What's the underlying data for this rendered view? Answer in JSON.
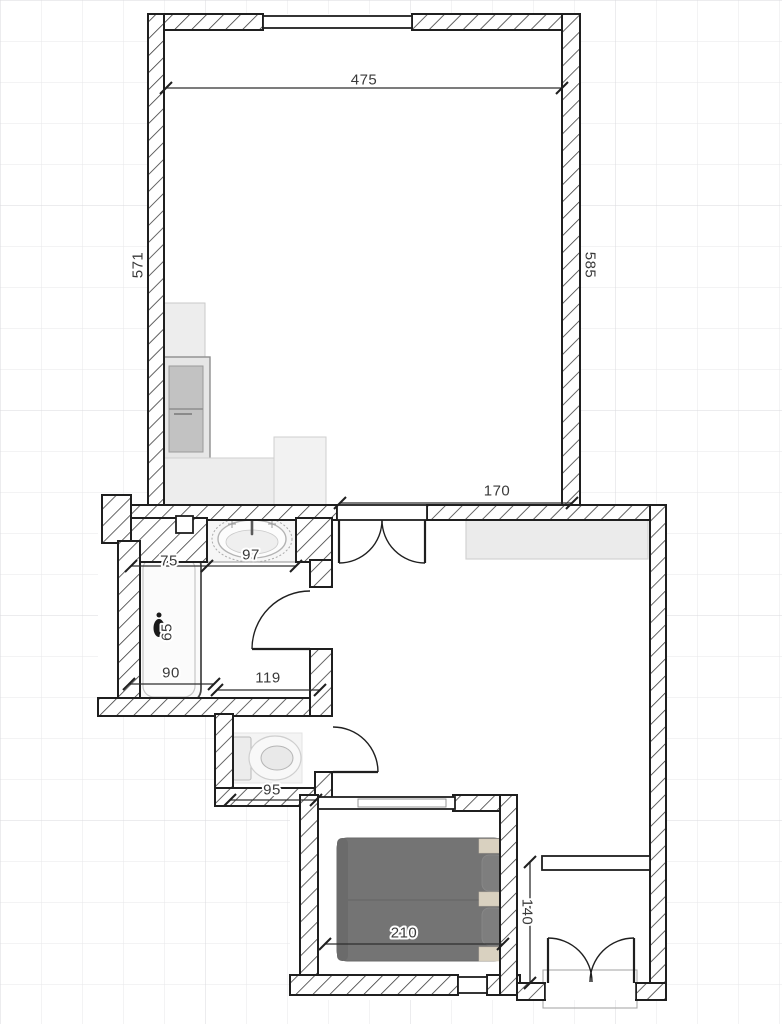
{
  "plan": {
    "title": "apartment-floor-plan",
    "dimensions": {
      "living_width": "475",
      "living_side_left": "571",
      "living_side_right": "585",
      "hall_top": "170",
      "bath_top_left": "75",
      "sink_width": "97",
      "tub_length": "65",
      "bath_bottom_left": "90",
      "bath_bottom_right": "119",
      "wc_width": "95",
      "bed_width": "210",
      "balcony_depth": "140"
    },
    "colors": {
      "wall_line": "#1f1f1f",
      "dim_text": "#3a3a3a",
      "grid_line": "#e7e7ea",
      "furniture_fill": "#ededed",
      "appliance_fill": "#c2c2c2",
      "bed_fill": "#747474",
      "pillow_accent": "#d9d1c0"
    }
  }
}
